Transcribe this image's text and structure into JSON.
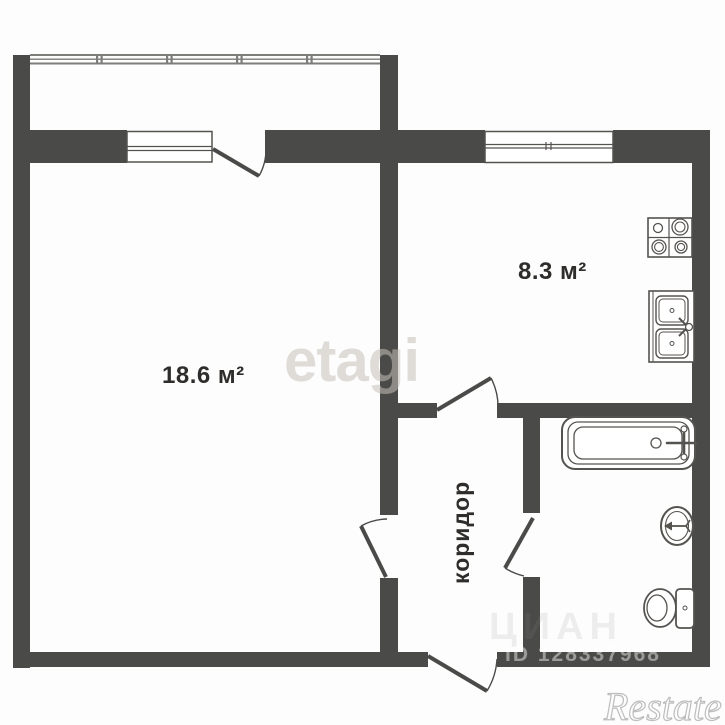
{
  "rooms": {
    "living": {
      "area": "18.6 м²"
    },
    "kitchen": {
      "area": "8.3 м²"
    },
    "corridor": {
      "name": "коридор"
    }
  },
  "watermarks": {
    "etagi": "etagi",
    "cian": "ЦИАН",
    "cian_id": "ID 128337968",
    "restate": "Restate"
  },
  "colors": {
    "wall": "#4a4a48",
    "glazing": "#7d7d7a",
    "fixture_stroke": "#55534f",
    "label": "#2e2d2b"
  }
}
